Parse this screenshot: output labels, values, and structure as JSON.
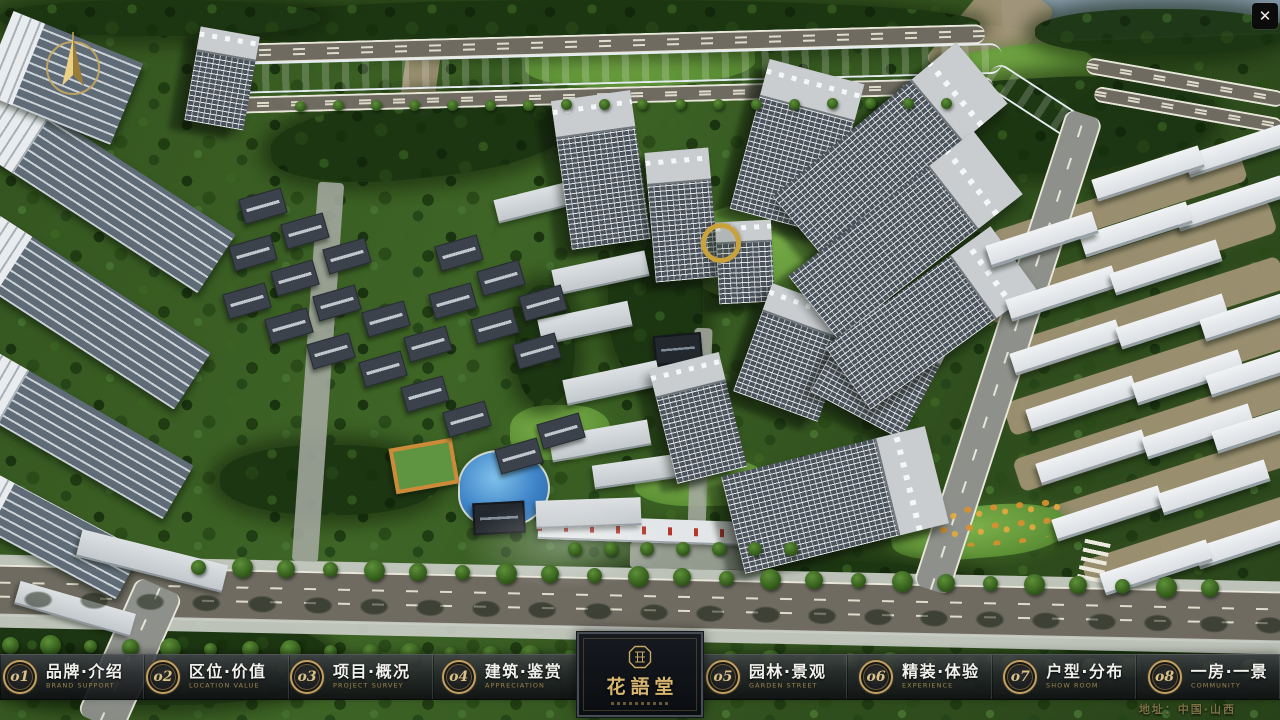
{
  "menu": {
    "left": [
      {
        "num": "o1",
        "zh": "品牌·介绍",
        "en": "BRAND SUPPORT"
      },
      {
        "num": "o2",
        "zh": "区位·价值",
        "en": "LOCATION VALUE"
      },
      {
        "num": "o3",
        "zh": "项目·概况",
        "en": "PROJECT SURVEY"
      },
      {
        "num": "o4",
        "zh": "建筑·鉴赏",
        "en": "APPRECIATION"
      }
    ],
    "right": [
      {
        "num": "o5",
        "zh": "园林·景观",
        "en": "GARDEN STREET"
      },
      {
        "num": "o6",
        "zh": "精装·体验",
        "en": "EXPERIENCE"
      },
      {
        "num": "o7",
        "zh": "户型·分布",
        "en": "SHOW ROOM"
      },
      {
        "num": "o8",
        "zh": "一房·一景",
        "en": "COMMUNITY"
      }
    ]
  },
  "logo": {
    "title": "花語堂"
  },
  "footer": {
    "address": "地址：中国·山西"
  },
  "close": {
    "glyph": "✕"
  },
  "icons": {
    "compass": "gold-north-arrow-compass",
    "seal": "octagonal-gold-seal",
    "close": "close-x"
  },
  "colors": {
    "accent_gold": "#c9a764",
    "menu_bar_bg": "#17191c",
    "menu_text_zh": "#f0f1ec",
    "menu_text_en": "#9c854e",
    "logo_gold": "#d8b670",
    "address_text": "#7d7146",
    "river_blue": "#3a74c6",
    "grass_green": "#3c6124",
    "road_gray": "#6f6b61",
    "building_white": "#e8ebee",
    "close_bg": "#0b0b0b"
  }
}
